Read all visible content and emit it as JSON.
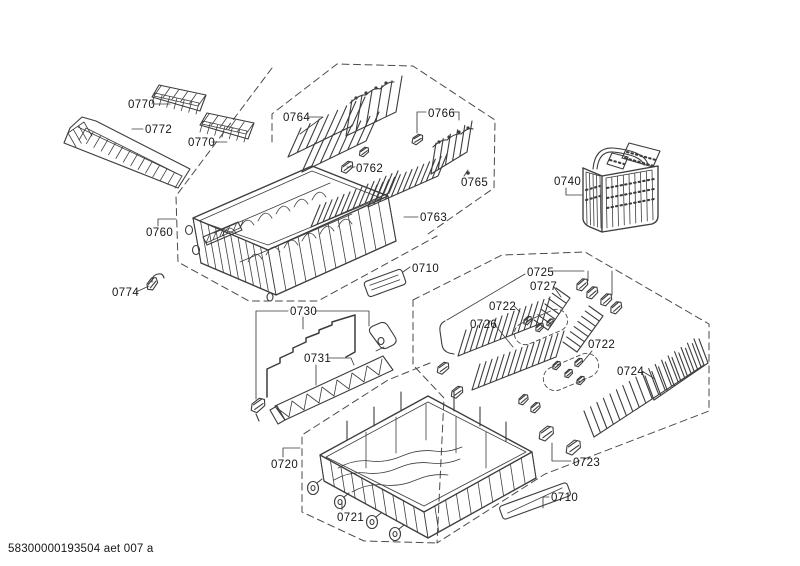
{
  "diagram_code": "58300000193504 aet 007 a",
  "labels": {
    "l0770a": "0770",
    "l0772": "0772",
    "l0770b": "0770",
    "l0760": "0760",
    "l0774": "0774",
    "l0764": "0764",
    "l0762": "0762",
    "l0766": "0766",
    "l0765": "0765",
    "l0763": "0763",
    "l0740": "0740",
    "l0710a": "0710",
    "l0730": "0730",
    "l0731": "0731",
    "l0720": "0720",
    "l0721": "0721",
    "l0725": "0725",
    "l0727": "0727",
    "l0722a": "0722",
    "l0726": "0726",
    "l0722b": "0722",
    "l0724": "0724",
    "l0723": "0723",
    "l0710b": "0710"
  },
  "colors": {
    "background": "#ffffff",
    "line_art": "#3d3d3d",
    "boundary": "#4a4a4a",
    "label_text": "#161616"
  }
}
